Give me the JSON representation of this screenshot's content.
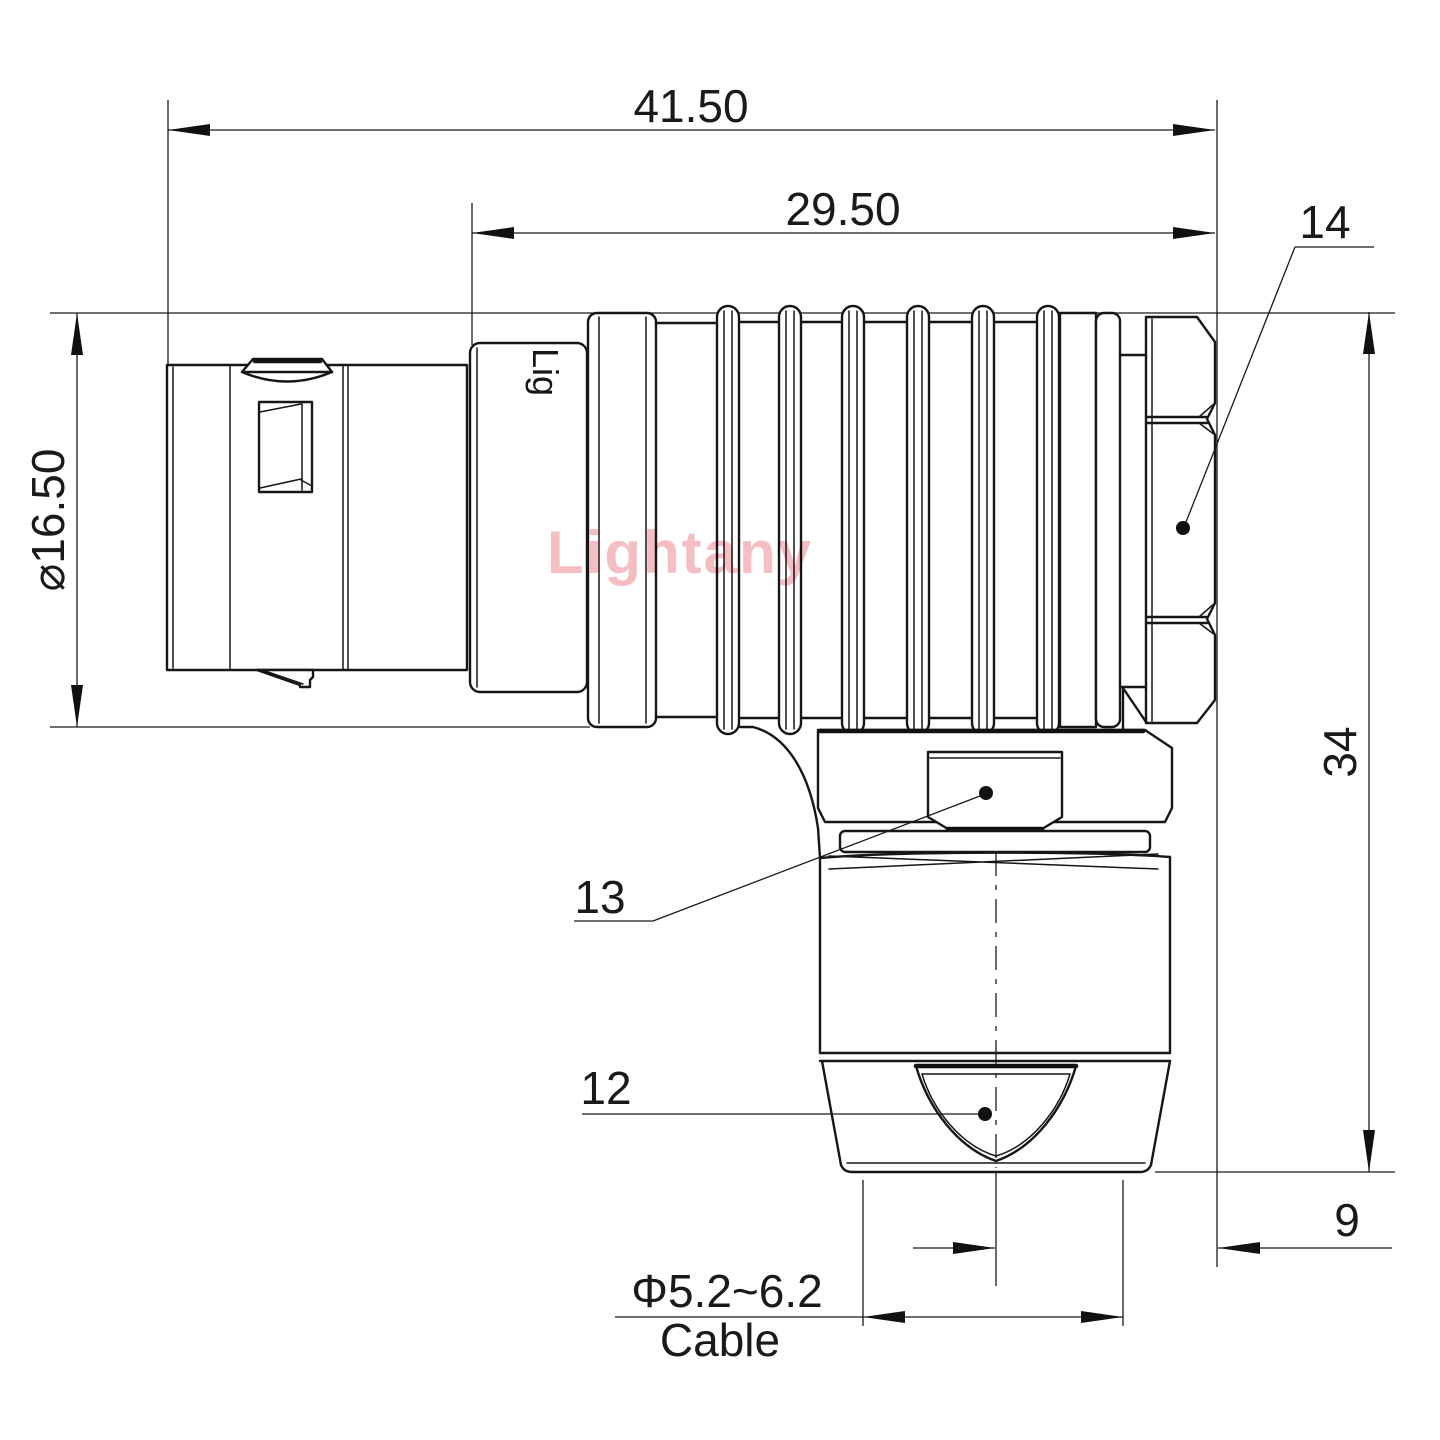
{
  "drawing": {
    "type": "technical-dimension-drawing",
    "subject": "right-angle push-pull circular connector, side elevation",
    "dimensions": {
      "overall_length": "41.50",
      "rear_length": "29.50",
      "front_diameter": "⌀16.50",
      "height": "34",
      "axis_offset": "9",
      "cable_diameter_range": "Φ5.2~6.2",
      "cable_label": "Cable"
    },
    "part_labels": {
      "back_nut": "14",
      "clamp_hex": "13",
      "cable_clamp": "12"
    },
    "body_marking": "Lig",
    "watermark": {
      "text": "Lightany",
      "color": "#f2b3b8"
    },
    "colors": {
      "line": "#161616",
      "thin_line": "#1a1a1a",
      "background": "#ffffff"
    }
  }
}
